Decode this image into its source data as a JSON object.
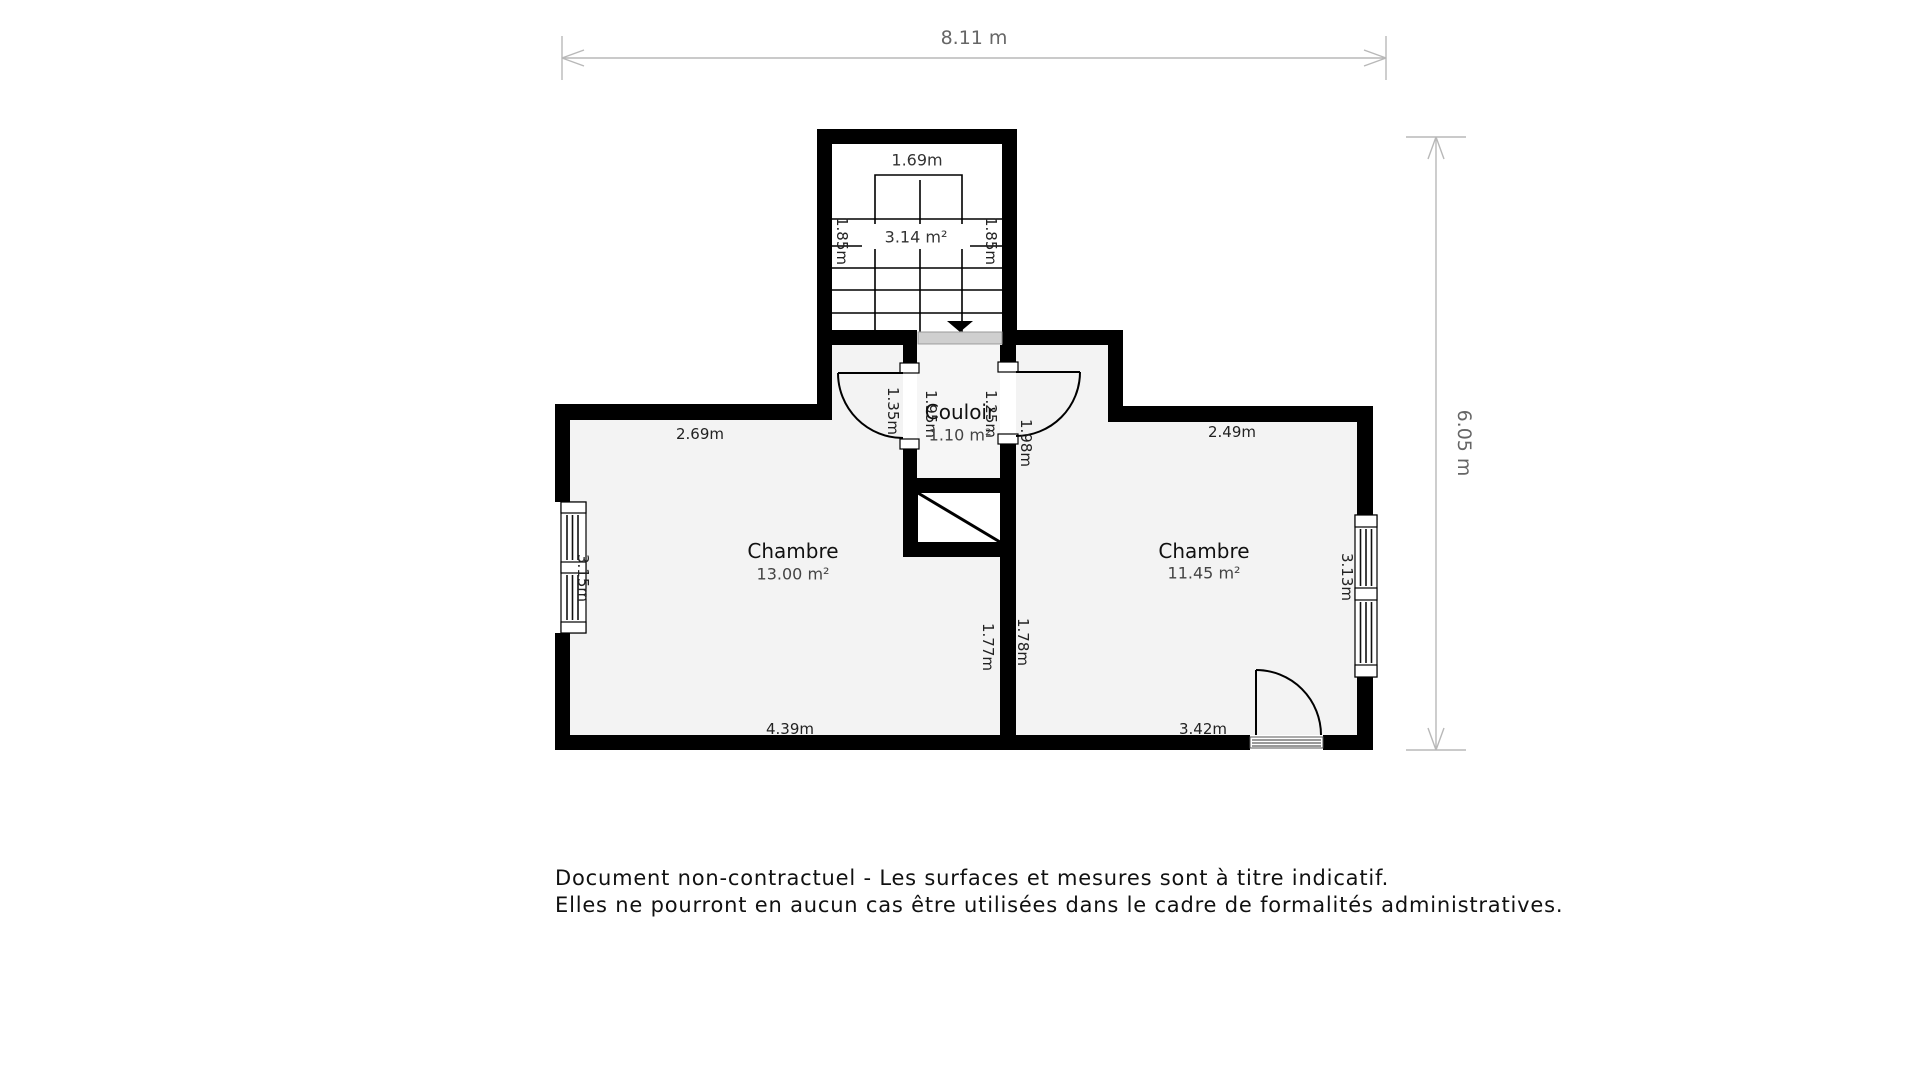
{
  "dimensions": {
    "top_label": "8.11 m",
    "right_label": "6.05 m"
  },
  "stairs": {
    "width_label": "1.69m",
    "area_label": "3.14 m²",
    "left_depth_label": "1.85m",
    "right_depth_label": "1.85m"
  },
  "couloir": {
    "name": "Couloir",
    "area_label": "1.10 m²",
    "left_outer_label": "1.35m",
    "left_inner_label": "1.95m",
    "right_inner_label": "1.25m",
    "right_outer_label": "1.98m"
  },
  "bedroom_left": {
    "name": "Chambre",
    "area_label": "13.00 m²",
    "top_label": "2.69m",
    "side_label": "3.15m",
    "bottom_label": "4.39m",
    "divider_label": "1.77m"
  },
  "bedroom_right": {
    "name": "Chambre",
    "area_label": "11.45 m²",
    "top_label": "2.49m",
    "side_label": "3.13m",
    "bottom_label": "3.42m",
    "divider_label": "1.78m"
  },
  "footer": {
    "line1": "Document non-contractuel - Les surfaces et mesures sont à titre indicatif.",
    "line2": "Elles ne pourront en aucun cas être utilisées dans le cadre de formalités administratives."
  },
  "colors": {
    "wall": "#000000",
    "room_fill": "#f3f3f3",
    "stair_fill": "#ffffff",
    "landing": "#cfcfcf",
    "dimension_line": "#b8b8b8",
    "dimension_text": "#666666",
    "label_text": "#111111",
    "measure_text": "#222222",
    "footer_text": "#111111"
  }
}
